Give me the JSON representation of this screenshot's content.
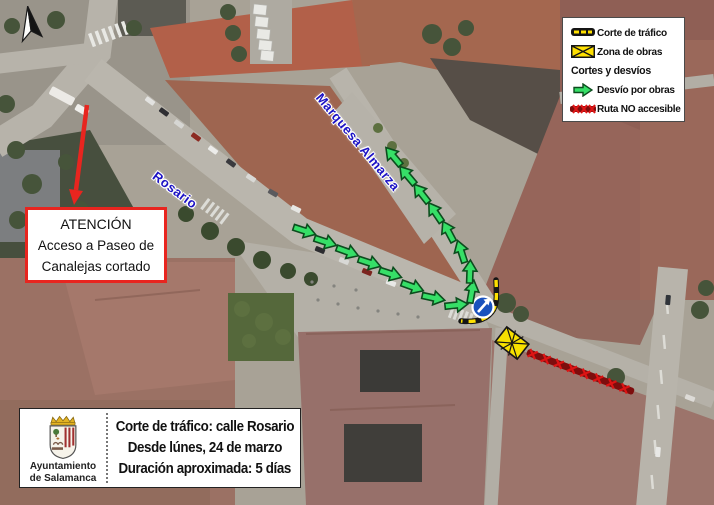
{
  "map": {
    "street_labels": {
      "rosario": "Rosario",
      "marquesa": "Marquesa Almarza"
    },
    "detour_arrows": [
      {
        "x": 305,
        "y": 231,
        "rot": 18
      },
      {
        "x": 326,
        "y": 242,
        "rot": 18
      },
      {
        "x": 348,
        "y": 252,
        "rot": 20
      },
      {
        "x": 370,
        "y": 263,
        "rot": 18
      },
      {
        "x": 391,
        "y": 274,
        "rot": 18
      },
      {
        "x": 413,
        "y": 287,
        "rot": 20
      },
      {
        "x": 434,
        "y": 298,
        "rot": 12
      },
      {
        "x": 457,
        "y": 305,
        "rot": -6
      },
      {
        "x": 472,
        "y": 291,
        "rot": -80
      },
      {
        "x": 470,
        "y": 271,
        "rot": -88
      },
      {
        "x": 461,
        "y": 251,
        "rot": -108
      },
      {
        "x": 448,
        "y": 231,
        "rot": -118
      },
      {
        "x": 435,
        "y": 212,
        "rot": -124
      },
      {
        "x": 421,
        "y": 193,
        "rot": -128
      },
      {
        "x": 407,
        "y": 175,
        "rot": -130
      },
      {
        "x": 393,
        "y": 156,
        "rot": -130
      }
    ],
    "signs": [
      {
        "name": "mandatory-direction-sign",
        "x": 483,
        "y": 307
      }
    ],
    "colors": {
      "detour_green": "#36df67",
      "closure_yellow": "#ffe000",
      "closure_black": "#151515",
      "no_access_dark_red": "#7e0d0d",
      "no_access_bright_red": "#dd1414",
      "attention_red": "#e8251f",
      "street_label_blue": "#1c12c4",
      "sign_blue": "#1952bd"
    }
  },
  "legend": {
    "items": [
      {
        "icon": "traffic-cut-icon",
        "label": "Corte de tráfico"
      },
      {
        "icon": "work-zone-icon",
        "label": "Zona de obras"
      },
      {
        "icon": null,
        "label": "Cortes y desvíos"
      },
      {
        "icon": "detour-arrow-icon",
        "label": "Desvío por obras"
      },
      {
        "icon": "no-access-icon",
        "label": "Ruta NO accesible"
      }
    ]
  },
  "attention_box": {
    "title": "ATENCIÓN",
    "line1": "Acceso a Paseo de",
    "line2": "Canalejas cortado"
  },
  "info_box": {
    "org_line1": "Ayuntamiento",
    "org_line2": "de Salamanca",
    "line1": "Corte de tráfico: calle Rosario",
    "line2": "Desde lúnes, 24 de marzo",
    "line3": "Duración aproximada: 5 días"
  }
}
